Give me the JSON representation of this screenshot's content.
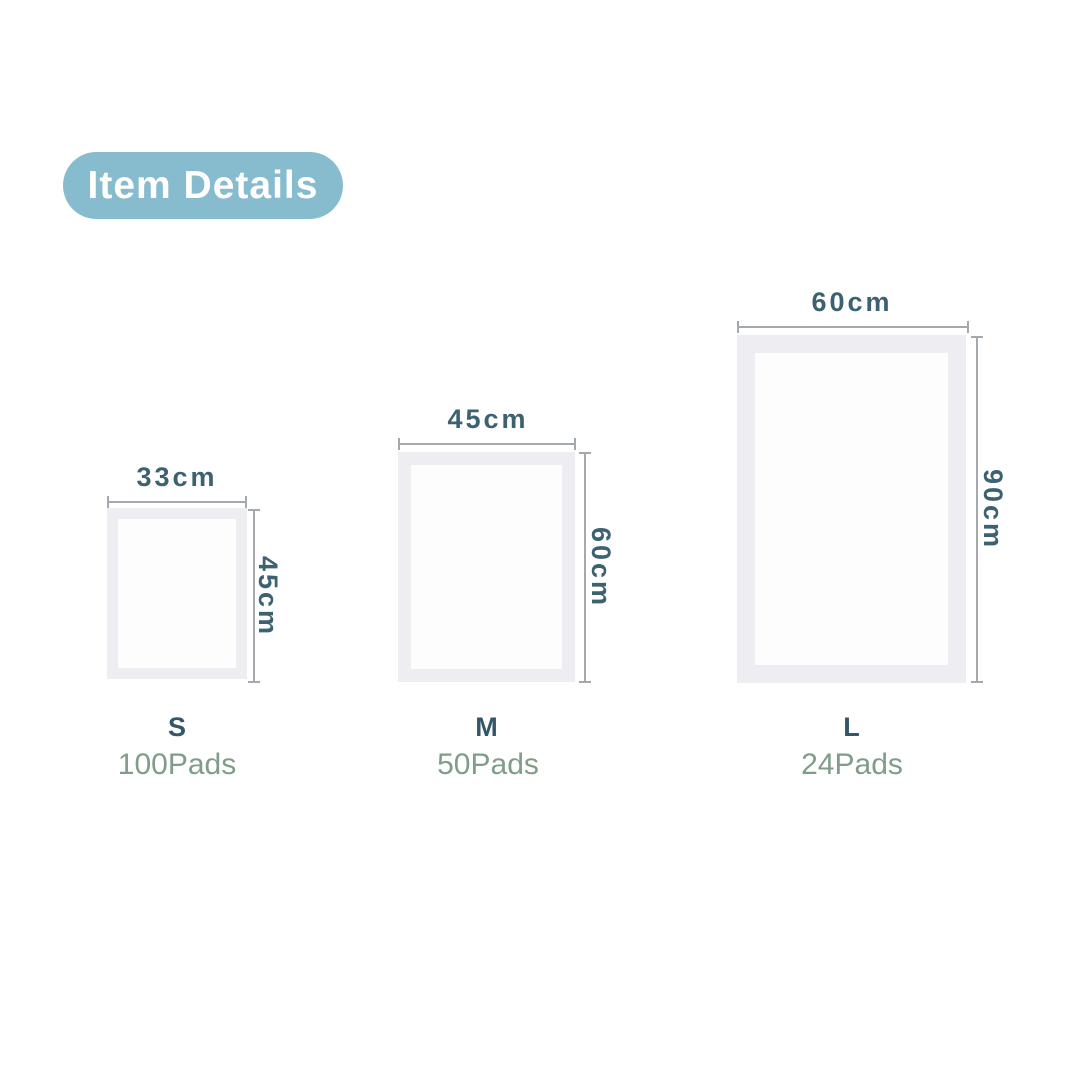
{
  "badge": {
    "label": "Item Details"
  },
  "sizes": [
    {
      "size": "S",
      "count": "100Pads",
      "width": "33cm",
      "height": "45cm"
    },
    {
      "size": "M",
      "count": "50Pads",
      "width": "45cm",
      "height": "60cm"
    },
    {
      "size": "L",
      "count": "24Pads",
      "width": "60cm",
      "height": "90cm"
    }
  ],
  "colors": {
    "background": "#ffffff",
    "badge_bg": "#87bccf",
    "badge_text": "#ffffff",
    "measure_text": "#3c6171",
    "dim_line": "#a4a9ae",
    "pad_frame": "#eeedf2",
    "pad_inner": "#fdfdfe",
    "size_text": "#32566a",
    "count_text": "#7f9d88"
  }
}
